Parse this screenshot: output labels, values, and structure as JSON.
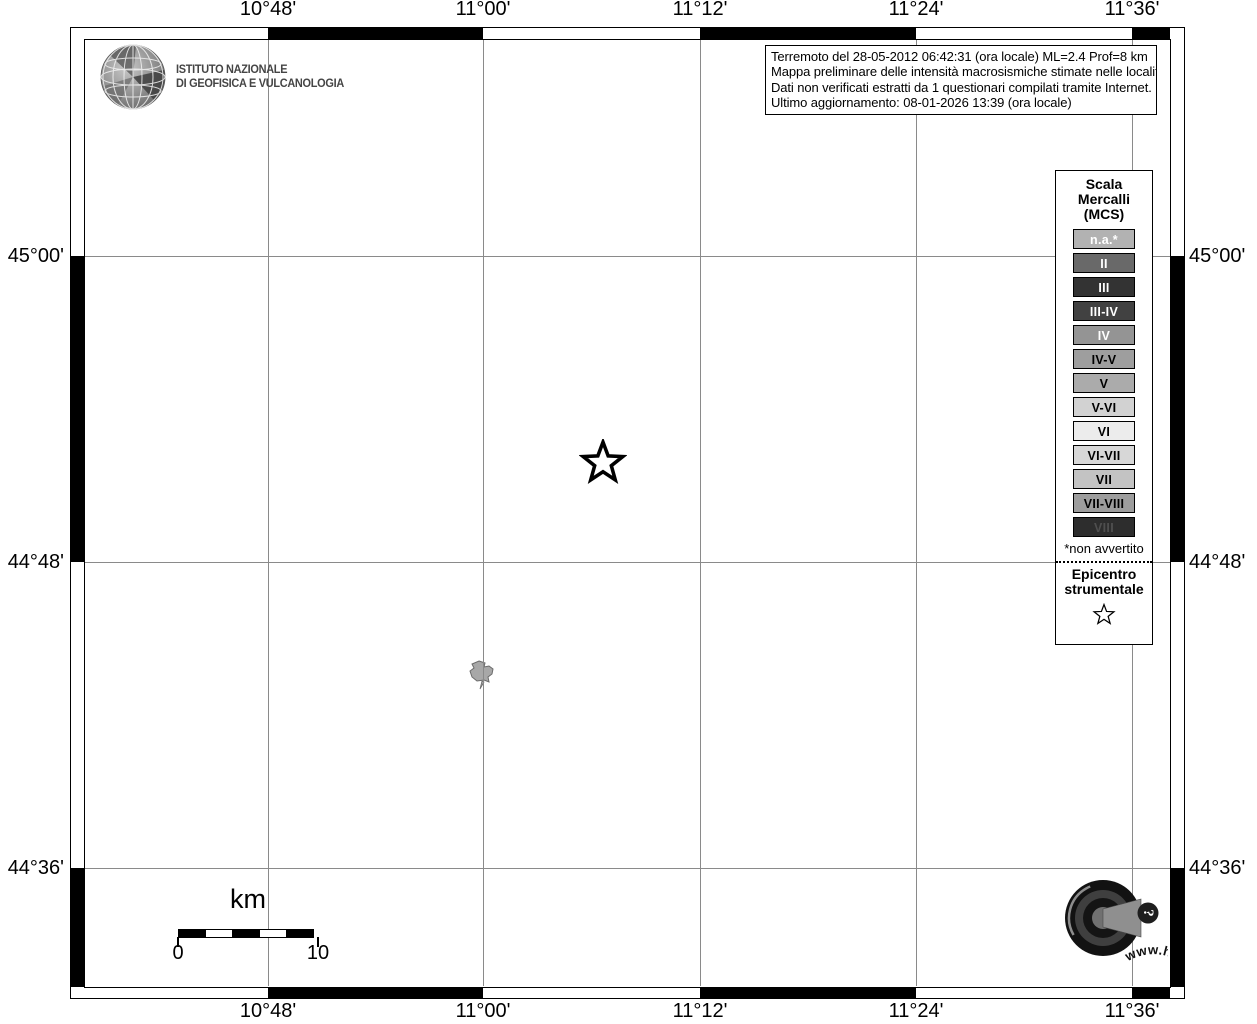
{
  "info_box": {
    "lines": [
      "Terremoto del 28-05-2012 06:42:31 (ora locale) ML=2.4 Prof=8 km",
      "Mappa preliminare delle intensità macrosismiche stimate nelle località",
      "Dati non verificati estratti da 1 questionari compilati tramite Internet.",
      "Ultimo aggiornamento: 08-01-2026 13:39 (ora locale)"
    ]
  },
  "branding": {
    "institute_lines": [
      "ISTITUTO NAZIONALE",
      "DI GEOFISICA E VULCANOLOGIA"
    ]
  },
  "axes": {
    "longitude": [
      "10°48'",
      "11°00'",
      "11°12'",
      "11°24'",
      "11°36'"
    ],
    "latitude": [
      "45°00'",
      "44°48'",
      "44°36'"
    ]
  },
  "legend": {
    "title_lines": [
      "Scala",
      "Mercalli",
      "(MCS)"
    ],
    "scale": [
      {
        "label": "n.a.*",
        "bg": "#b2b2b2",
        "fg": "#ffffff"
      },
      {
        "label": "II",
        "bg": "#696969",
        "fg": "#ffffff"
      },
      {
        "label": "III",
        "bg": "#333333",
        "fg": "#ffffff"
      },
      {
        "label": "III-IV",
        "bg": "#414141",
        "fg": "#ffffff"
      },
      {
        "label": "IV",
        "bg": "#949494",
        "fg": "#ffffff"
      },
      {
        "label": "IV-V",
        "bg": "#9e9e9e",
        "fg": "#000000"
      },
      {
        "label": "V",
        "bg": "#ababab",
        "fg": "#000000"
      },
      {
        "label": "V-VI",
        "bg": "#d2d2d2",
        "fg": "#000000"
      },
      {
        "label": "VI",
        "bg": "#ececec",
        "fg": "#000000"
      },
      {
        "label": "VI-VII",
        "bg": "#d7d7d7",
        "fg": "#000000"
      },
      {
        "label": "VII",
        "bg": "#c3c3c3",
        "fg": "#000000"
      },
      {
        "label": "VII-VIII",
        "bg": "#9d9d9d",
        "fg": "#000000"
      },
      {
        "label": "VIII",
        "bg": "#2d2d2d",
        "fg": "#4f4f4f"
      }
    ],
    "footnote": "*non avvertito",
    "epicenter_lines": [
      "Epicentro",
      "strumentale"
    ]
  },
  "scale_bar": {
    "unit": "km",
    "start_label": "0",
    "end_label": "10"
  },
  "badge_logo": {
    "url_text": "www.haisentitoilterremoto.it",
    "question_mark": "?"
  },
  "colors": {
    "grid": "#8a8a8a",
    "frame": "#000000",
    "locality_fill": "#a8a8a8"
  }
}
